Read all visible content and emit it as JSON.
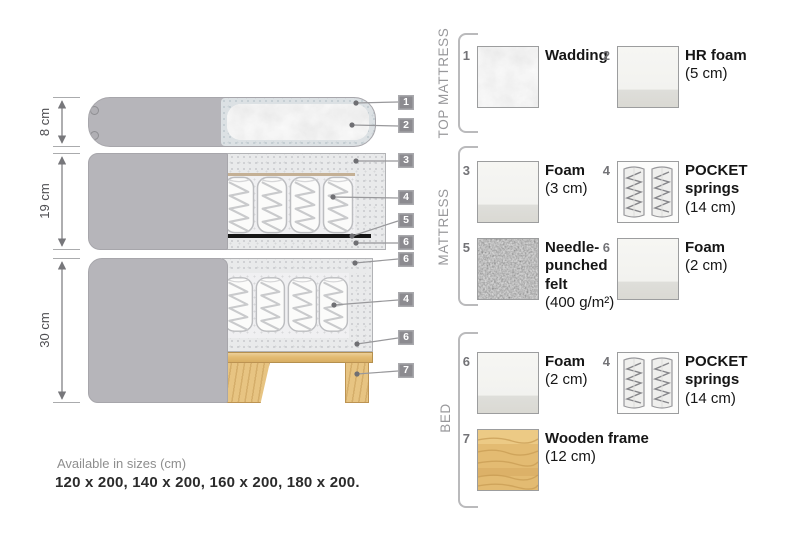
{
  "diagram": {
    "dimensions": [
      {
        "label": "8 cm"
      },
      {
        "label": "19 cm"
      },
      {
        "label": "30 cm"
      }
    ],
    "callouts": [
      {
        "num": "1"
      },
      {
        "num": "2"
      },
      {
        "num": "3"
      },
      {
        "num": "4"
      },
      {
        "num": "5"
      },
      {
        "num": "6"
      },
      {
        "num": "6"
      },
      {
        "num": "4"
      },
      {
        "num": "6"
      },
      {
        "num": "7"
      }
    ]
  },
  "legend": {
    "sections": [
      {
        "title": "TOP MATTRESS",
        "items": [
          {
            "num": "1",
            "name": "Wadding",
            "size": "",
            "swatch": "wadding-texture"
          },
          {
            "num": "2",
            "name": "HR foam",
            "size": "(5 cm)",
            "swatch": "foam"
          }
        ]
      },
      {
        "title": "MATTRESS",
        "items": [
          {
            "num": "3",
            "name": "Foam",
            "size": "(3 cm)",
            "swatch": "foam"
          },
          {
            "num": "4",
            "name": "POCKET springs",
            "size": "(14 cm)",
            "swatch": "pocket-springs"
          },
          {
            "num": "5",
            "name": "Needle-punched felt",
            "size": "(400 g/m²)",
            "swatch": "felt-texture"
          },
          {
            "num": "6",
            "name": "Foam",
            "size": "(2 cm)",
            "swatch": "foam"
          }
        ]
      },
      {
        "title": "BED",
        "items": [
          {
            "num": "6",
            "name": "Foam",
            "size": "(2 cm)",
            "swatch": "foam"
          },
          {
            "num": "4",
            "name": "POCKET springs",
            "size": "(14 cm)",
            "swatch": "pocket-springs"
          },
          {
            "num": "7",
            "name": "Wooden frame",
            "size": "(12 cm)",
            "swatch": "wood-texture"
          }
        ]
      }
    ]
  },
  "footer": {
    "availability": "Available in sizes (cm)",
    "sizes": "120 x 200, 140 x 200, 160 x 200, 180 x 200."
  },
  "colors": {
    "cover_grey": "#b6b5ba",
    "foam_speckle": "#e9eaeb",
    "wood": "#e3bb72",
    "felt_dark": "#6e6e6e",
    "badge_grey": "#8c8b90",
    "text_dark": "#161616",
    "text_grey": "#8e8e8e"
  }
}
